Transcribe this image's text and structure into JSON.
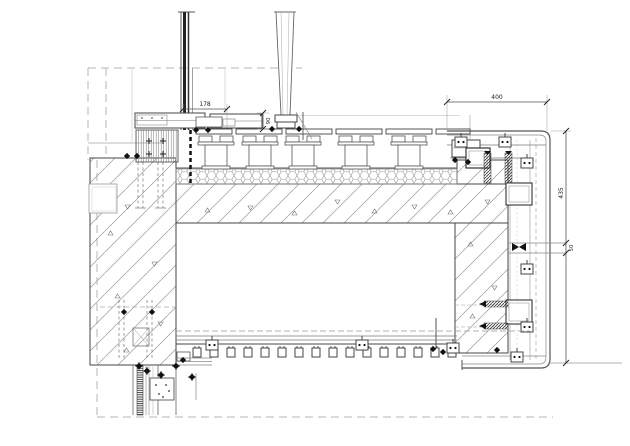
{
  "drawing": {
    "dimensions": {
      "d178": "178",
      "d90": "90",
      "d400": "400",
      "d435": "435",
      "d50": "50"
    },
    "colors": {
      "background": "#ffffff",
      "line_dark": "#333333",
      "line_mid": "#777777",
      "line_light": "#aaaaaa",
      "hatch": "#9a9a9a",
      "fastener": "#111111"
    }
  }
}
